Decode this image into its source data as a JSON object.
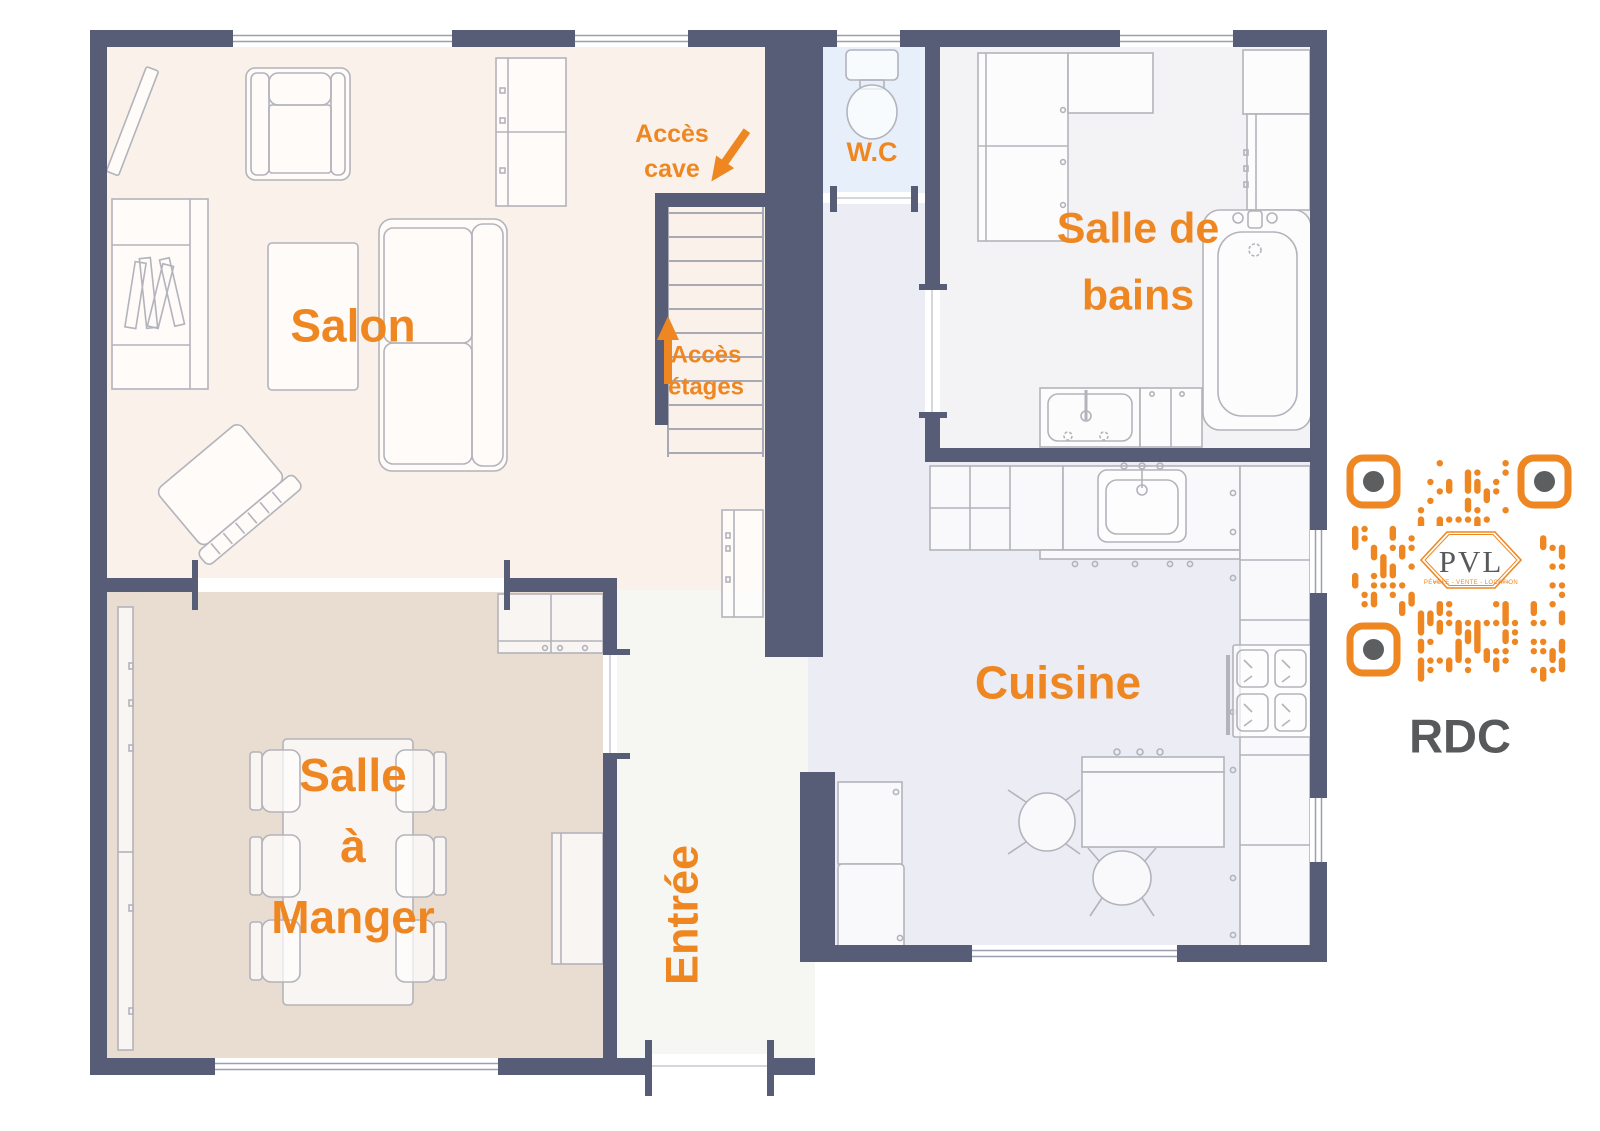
{
  "accent_color": "#ee8722",
  "wall_color": "#575c77",
  "floor_label": "RDC",
  "rooms": {
    "salon": {
      "label": "Salon"
    },
    "salle_a_manger": {
      "lines": [
        "Salle",
        "à",
        "Manger"
      ]
    },
    "cuisine": {
      "label": "Cuisine"
    },
    "entree": {
      "label": "Entrée"
    },
    "salle_de_bains": {
      "lines": [
        "Salle de",
        "bains"
      ]
    },
    "wc": {
      "label": "W.C"
    }
  },
  "annotations": {
    "acces_cave": {
      "lines": [
        "Accès",
        "cave"
      ]
    },
    "acces_etages": {
      "lines": [
        "Accès",
        "étages"
      ]
    }
  },
  "qr": {
    "logo": "PVL",
    "tagline": "PÉVÈLE - VENTE - LOCATION"
  }
}
